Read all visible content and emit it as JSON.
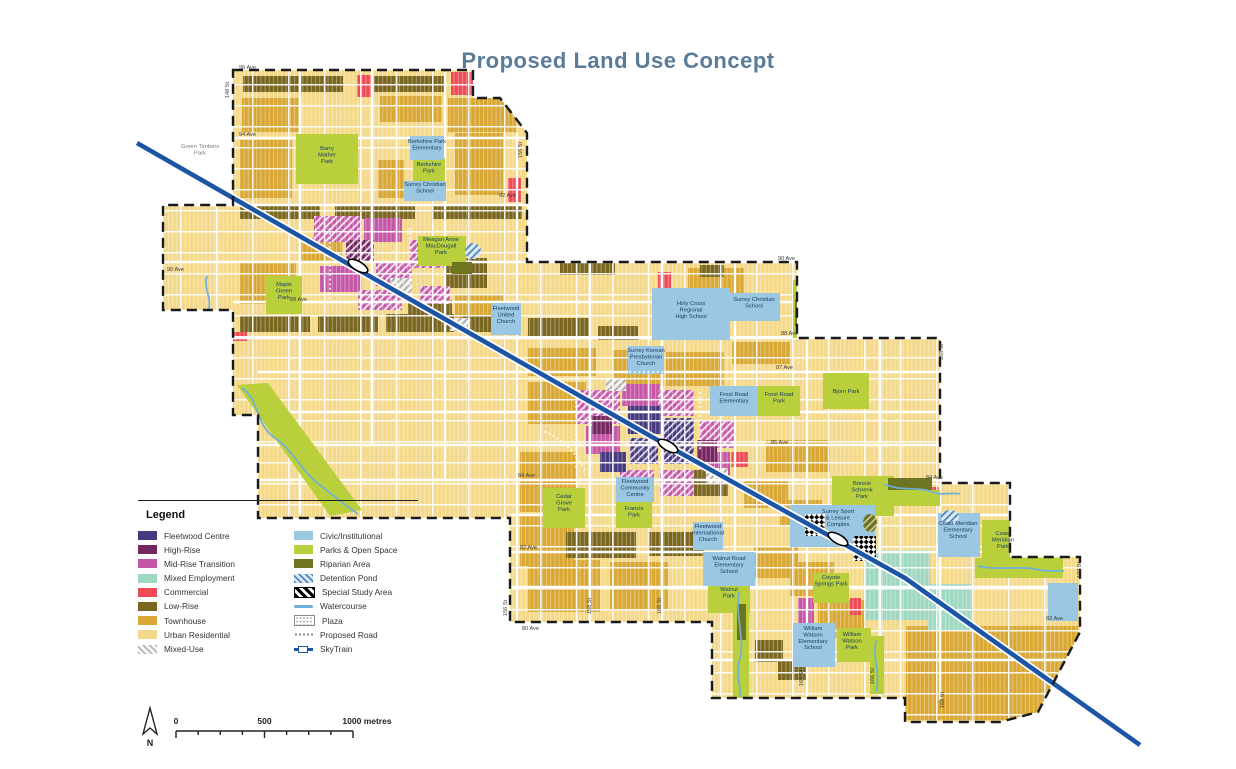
{
  "title": "Proposed Land Use Concept",
  "palette": {
    "urban_residential": "#f5d98b",
    "townhouse": "#d9a733",
    "low_rise": "#7a661f",
    "commercial": "#ee4b55",
    "mid_rise": "#c657a7",
    "high_rise": "#75265f",
    "fleetwood_centre": "#46397f",
    "mixed_employment": "#9ed8c0",
    "civic": "#9cc7e2",
    "park": "#b9d03c",
    "riparian": "#6d7520",
    "watercourse": "#6fb0d9",
    "skytrain": "#1d55a5",
    "mixed_use_hatch": "#b5b5b5",
    "detention_stripe": "#4f86bb",
    "title_color": "#5b7b98",
    "boundary": "#1a1a1a"
  },
  "legend": {
    "heading": "Legend",
    "columns": [
      [
        {
          "label": "Fleetwood Centre",
          "swatch": "solid",
          "color": "#46397f"
        },
        {
          "label": "High-Rise",
          "swatch": "solid",
          "color": "#75265f"
        },
        {
          "label": "Mid-Rise Transition",
          "swatch": "solid",
          "color": "#c657a7"
        },
        {
          "label": "Mixed Employment",
          "swatch": "solid",
          "color": "#9ed8c0"
        },
        {
          "label": "Commercial",
          "swatch": "solid",
          "color": "#ee4b55"
        },
        {
          "label": "Low-Rise",
          "swatch": "solid",
          "color": "#7a661f"
        },
        {
          "label": "Townhouse",
          "swatch": "solid",
          "color": "#d9a733"
        },
        {
          "label": "Urban Residential",
          "swatch": "solid",
          "color": "#f5d98b"
        },
        {
          "label": "Mixed-Use",
          "swatch": "hatch",
          "color": "#b5b5b5",
          "bg": "#fafafa"
        }
      ],
      [
        {
          "label": "Civic/Institutional",
          "swatch": "solid",
          "color": "#9cc7e2"
        },
        {
          "label": "Parks & Open Space",
          "swatch": "solid",
          "color": "#b9d03c"
        },
        {
          "label": "Riparian Area",
          "swatch": "solid",
          "color": "#6d7520"
        },
        {
          "label": "Detention Pond",
          "swatch": "hatch",
          "color": "#4f86bb",
          "bg": "#dce9f4"
        },
        {
          "label": "Special Study Area",
          "swatch": "checker"
        },
        {
          "label": "Watercourse",
          "swatch": "line",
          "color": "#6fb0d9"
        },
        {
          "label": "Plaza",
          "swatch": "dots"
        },
        {
          "label": "Proposed Road",
          "swatch": "dotline"
        },
        {
          "label": "SkyTrain",
          "swatch": "sky"
        }
      ]
    ]
  },
  "scale_bar": {
    "north_label": "N",
    "tick_labels": [
      "0",
      "500",
      "1000 metres"
    ]
  },
  "map": {
    "avenue_labels": [
      {
        "t": "96 Ave",
        "x": 239,
        "y": 69
      },
      {
        "t": "94 Ave",
        "x": 239,
        "y": 136
      },
      {
        "t": "92 Ave",
        "x": 499,
        "y": 197
      },
      {
        "t": "90 Ave",
        "x": 167,
        "y": 271
      },
      {
        "t": "90 Ave",
        "x": 778,
        "y": 260
      },
      {
        "t": "88 Ave",
        "x": 290,
        "y": 301
      },
      {
        "t": "88 Ave",
        "x": 781,
        "y": 335
      },
      {
        "t": "87 Ave",
        "x": 776,
        "y": 369
      },
      {
        "t": "85 Ave",
        "x": 771,
        "y": 444
      },
      {
        "t": "84 Ave",
        "x": 518,
        "y": 477
      },
      {
        "t": "84 Ave",
        "x": 926,
        "y": 479
      },
      {
        "t": "82 Ave",
        "x": 520,
        "y": 549
      },
      {
        "t": "82 Ave",
        "x": 1046,
        "y": 620
      },
      {
        "t": "80 Ave",
        "x": 522,
        "y": 630
      }
    ],
    "street_labels": [
      {
        "t": "148 St",
        "x": 229,
        "y": 90
      },
      {
        "t": "156 St",
        "x": 522,
        "y": 150
      },
      {
        "t": "156 St",
        "x": 507,
        "y": 608
      },
      {
        "t": "158 St",
        "x": 591,
        "y": 606
      },
      {
        "t": "160 St",
        "x": 661,
        "y": 606
      },
      {
        "t": "164 St",
        "x": 803,
        "y": 678
      },
      {
        "t": "166 St",
        "x": 874,
        "y": 676
      },
      {
        "t": "168 St",
        "x": 943,
        "y": 352
      },
      {
        "t": "168 St",
        "x": 944,
        "y": 700
      },
      {
        "t": "172 St",
        "x": 1081,
        "y": 570
      }
    ],
    "feature_labels": [
      {
        "t": "Green Timbers\nPark",
        "x": 200,
        "y": 148,
        "tone": "gray"
      },
      {
        "t": "Barry\nMather\nPark",
        "x": 327,
        "y": 150
      },
      {
        "t": "Berkshire Park\nElementary",
        "x": 427,
        "y": 143
      },
      {
        "t": "Berkshire\nPark",
        "x": 429,
        "y": 166
      },
      {
        "t": "Surrey Christian\nSchool",
        "x": 425,
        "y": 186
      },
      {
        "t": "Meagan Anne\nMacDougall\nPark",
        "x": 441,
        "y": 241
      },
      {
        "t": "Maple\nGreen\nPark",
        "x": 284,
        "y": 286
      },
      {
        "t": "Fleetwood\nUnited\nChurch",
        "x": 506,
        "y": 310
      },
      {
        "t": "Holy Cross\nRegional\nHigh School",
        "x": 691,
        "y": 305
      },
      {
        "t": "Surrey Christian\nSchool",
        "x": 754,
        "y": 301
      },
      {
        "t": "Surrey Korean\nPresbyterian\nChurch",
        "x": 646,
        "y": 352
      },
      {
        "t": "Frost Road\nElementary",
        "x": 734,
        "y": 396
      },
      {
        "t": "Frost Road\nPark",
        "x": 779,
        "y": 396
      },
      {
        "t": "Bjorn Park",
        "x": 846,
        "y": 393
      },
      {
        "t": "Fleetwood\nCommunity\nCentre",
        "x": 635,
        "y": 483
      },
      {
        "t": "Francis\nPark",
        "x": 634,
        "y": 510
      },
      {
        "t": "Cedar\nGrove\nPark",
        "x": 564,
        "y": 498
      },
      {
        "t": "Fleetwood\nInternational\nChurch",
        "x": 708,
        "y": 528
      },
      {
        "t": "Walnut Road\nElementary\nSchool",
        "x": 729,
        "y": 560
      },
      {
        "t": "Walnut\nPark",
        "x": 729,
        "y": 591
      },
      {
        "t": "Surrey Sport\n& Leisure\nComplex",
        "x": 838,
        "y": 513
      },
      {
        "t": "Bonnie\nSchrenk\nPark",
        "x": 862,
        "y": 485
      },
      {
        "t": "Coast Meridian\nElementary\nSchool",
        "x": 958,
        "y": 525
      },
      {
        "t": "Coast\nMeridian\nPark",
        "x": 1003,
        "y": 535
      },
      {
        "t": "Coyote\nSprings Park",
        "x": 831,
        "y": 579
      },
      {
        "t": "William\nWatson\nElementary\nSchool",
        "x": 813,
        "y": 630
      },
      {
        "t": "William\nWatson\nPark",
        "x": 852,
        "y": 636
      }
    ]
  }
}
